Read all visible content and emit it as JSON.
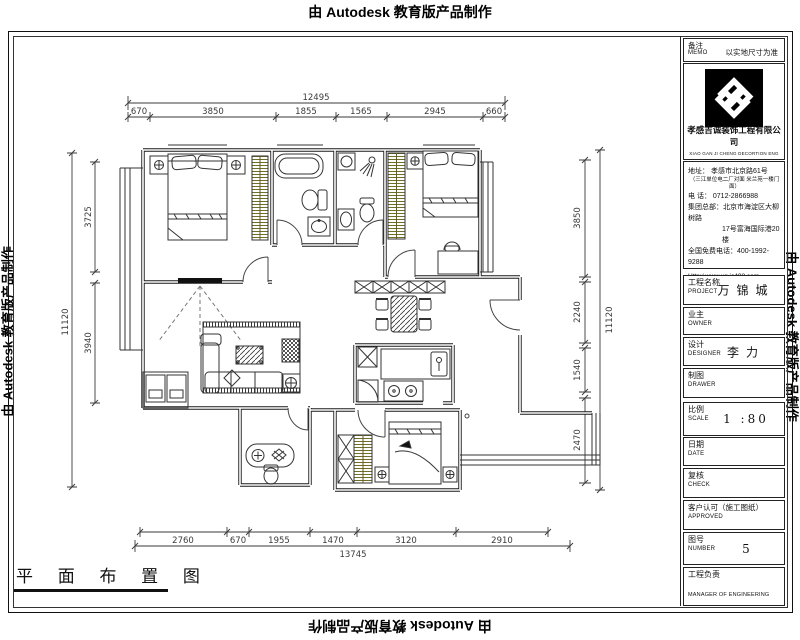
{
  "watermark": {
    "text": "由 Autodesk 教育版产品制作"
  },
  "plan_title": "平 面 布 置 图",
  "memo": {
    "label": "备注",
    "label_en": "MEMO",
    "value": "以实地尺寸为准"
  },
  "company": {
    "name": "孝感吉诚装饰工程有限公司",
    "name_en": "XIAO GAN JI CHENG DECORTION ENG",
    "address_line": "地址：  孝感市北京路61号",
    "address_note": "（三江单位电二厂对面 米兰苑一楼门面）",
    "phone_line": "电    话：  0712-2866988",
    "hq_line1": "集团总部：北京市海淀区大柳树路",
    "hq_line2": "17号富海国际港20楼",
    "hotline_line": "全国免费电话：400-1992-9288",
    "website": "Http:/ www.xg.jc498.com"
  },
  "fields": [
    {
      "label": "工程名称",
      "label_en": "PROJECT",
      "value": "万锦城"
    },
    {
      "label": "业主",
      "label_en": "OWNER",
      "value": ""
    },
    {
      "label": "设计",
      "label_en": "DESIGNER",
      "value": "李力"
    },
    {
      "label": "制图",
      "label_en": "DRAWER",
      "value": ""
    },
    {
      "label": "比例",
      "label_en": "SCALE",
      "value": "1  :80"
    },
    {
      "label": "日期",
      "label_en": "DATE",
      "value": ""
    },
    {
      "label": "复核",
      "label_en": "CHECK",
      "value": ""
    },
    {
      "label": "客户认可（施工图纸）",
      "label_en": "APPROVED",
      "value": ""
    },
    {
      "label": "图号",
      "label_en": "NUMBER",
      "value": "5"
    },
    {
      "label": "工程负责",
      "label_en": "MANAGER OF ENGINEERING",
      "value": ""
    }
  ],
  "dimensions": {
    "top": {
      "total": "12495",
      "segments": [
        "670",
        "3850",
        "1855",
        "1565",
        "2945",
        "660"
      ]
    },
    "bottom": {
      "total": "13745",
      "segments": [
        "2760",
        "670",
        "1955",
        "1470",
        "3120",
        "2910"
      ]
    },
    "left": {
      "total": "11120",
      "segments": [
        "3725",
        "3940"
      ]
    },
    "right": {
      "total": "11120",
      "segments": [
        "3850",
        "2240",
        "1540",
        "2470"
      ]
    }
  },
  "colors": {
    "wall": "#1a1a1a",
    "dim": "#3a3a3a",
    "wardrobe_hatch": "#6f6f28",
    "logo_bg": "#000000"
  }
}
